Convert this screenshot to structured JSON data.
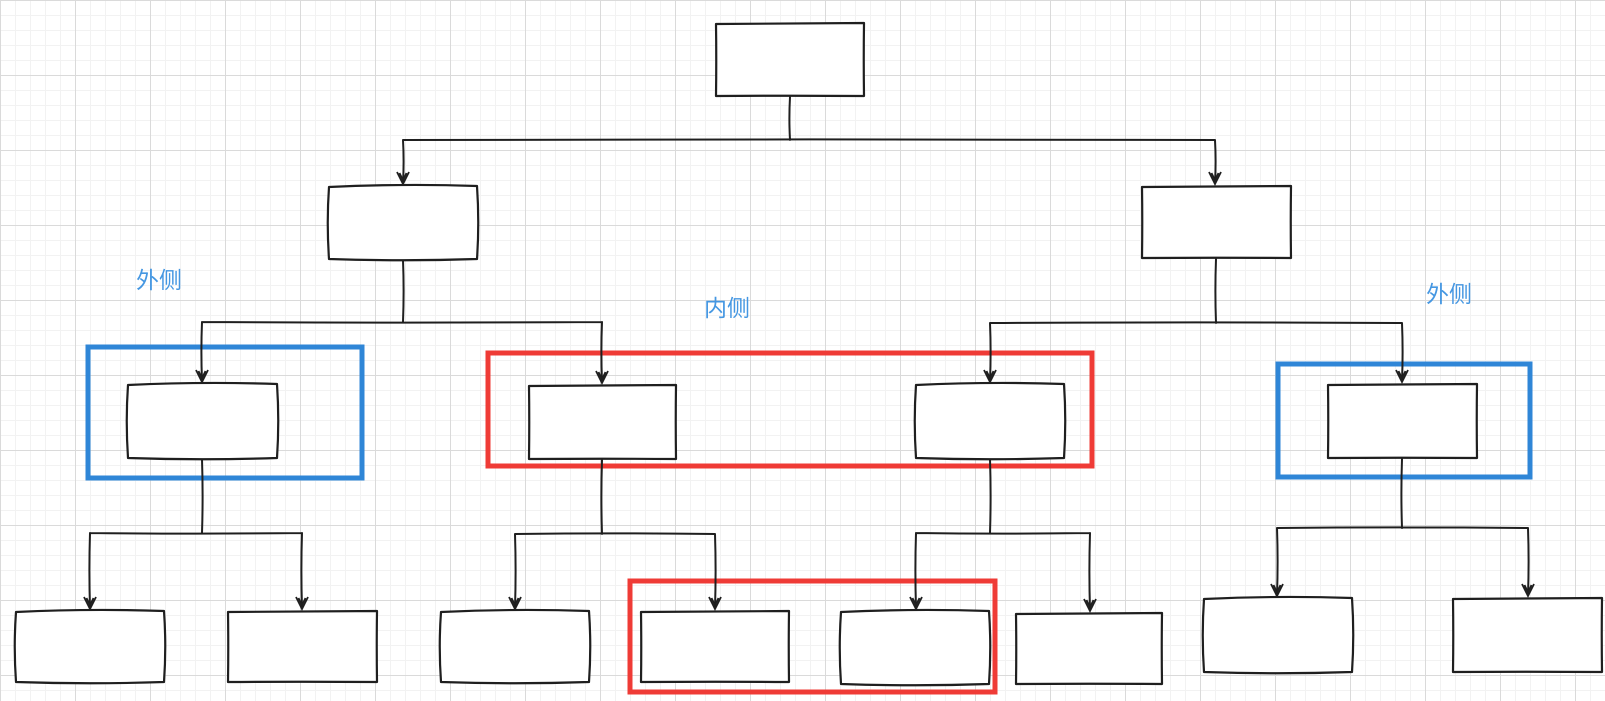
{
  "canvas": {
    "width": 1605,
    "height": 701,
    "background_color": "#ffffff",
    "grid": {
      "minor_color": "#f2f2f2",
      "major_color": "#dadada",
      "minor_step": 15,
      "major_step": 75
    }
  },
  "palette": {
    "node_stroke": "#1f1f1f",
    "node_fill": "#ffffff",
    "edge_color": "#1f1f1f",
    "blue": "#2f86d7",
    "red": "#ef3b36",
    "label_blue": "#4597e2"
  },
  "labels": [
    {
      "id": "label-outer-left",
      "text": "外侧",
      "x": 136,
      "y": 288,
      "color": "label_blue"
    },
    {
      "id": "label-inner",
      "text": "内侧",
      "x": 704,
      "y": 316,
      "color": "label_blue"
    },
    {
      "id": "label-outer-right",
      "text": "外侧",
      "x": 1426,
      "y": 302,
      "color": "label_blue"
    }
  ],
  "nodes": [
    {
      "id": "root",
      "x": 715,
      "y": 22,
      "w": 150,
      "h": 75
    },
    {
      "id": "branch-left",
      "x": 328,
      "y": 185,
      "w": 150,
      "h": 75
    },
    {
      "id": "branch-right",
      "x": 1141,
      "y": 185,
      "w": 151,
      "h": 74
    },
    {
      "id": "outer-left",
      "x": 127,
      "y": 383,
      "w": 151,
      "h": 76
    },
    {
      "id": "inner-left",
      "x": 528,
      "y": 384,
      "w": 149,
      "h": 76
    },
    {
      "id": "inner-right",
      "x": 915,
      "y": 383,
      "w": 150,
      "h": 76
    },
    {
      "id": "outer-right",
      "x": 1327,
      "y": 383,
      "w": 151,
      "h": 76
    },
    {
      "id": "leaf-1",
      "x": 15,
      "y": 610,
      "w": 150,
      "h": 73
    },
    {
      "id": "leaf-2",
      "x": 227,
      "y": 610,
      "w": 151,
      "h": 73
    },
    {
      "id": "leaf-3",
      "x": 440,
      "y": 610,
      "w": 150,
      "h": 73
    },
    {
      "id": "leaf-4",
      "x": 640,
      "y": 610,
      "w": 150,
      "h": 73
    },
    {
      "id": "leaf-5",
      "x": 840,
      "y": 610,
      "w": 150,
      "h": 75
    },
    {
      "id": "leaf-6",
      "x": 1015,
      "y": 612,
      "w": 148,
      "h": 73
    },
    {
      "id": "leaf-7",
      "x": 1203,
      "y": 597,
      "w": 150,
      "h": 76
    },
    {
      "id": "leaf-8",
      "x": 1452,
      "y": 597,
      "w": 151,
      "h": 76
    }
  ],
  "edges": [
    {
      "id": "root-to-branches",
      "from_x": 790,
      "from_y": 97,
      "split_y": 140,
      "targets": [
        {
          "x": 403,
          "y": 185
        },
        {
          "x": 1215,
          "y": 185
        }
      ]
    },
    {
      "id": "branch-left-children",
      "from_x": 403,
      "from_y": 260,
      "split_y": 322,
      "targets": [
        {
          "x": 202,
          "y": 383
        },
        {
          "x": 602,
          "y": 384
        }
      ]
    },
    {
      "id": "branch-right-children",
      "from_x": 1216,
      "from_y": 259,
      "split_y": 323,
      "targets": [
        {
          "x": 990,
          "y": 383
        },
        {
          "x": 1402,
          "y": 383
        }
      ]
    },
    {
      "id": "outer-left-children",
      "from_x": 202,
      "from_y": 459,
      "split_y": 533,
      "targets": [
        {
          "x": 90,
          "y": 610
        },
        {
          "x": 302,
          "y": 610
        }
      ]
    },
    {
      "id": "inner-left-children",
      "from_x": 602,
      "from_y": 460,
      "split_y": 534,
      "targets": [
        {
          "x": 515,
          "y": 610
        },
        {
          "x": 715,
          "y": 610
        }
      ]
    },
    {
      "id": "inner-right-children",
      "from_x": 990,
      "from_y": 459,
      "split_y": 533,
      "targets": [
        {
          "x": 916,
          "y": 610
        },
        {
          "x": 1090,
          "y": 612
        }
      ]
    },
    {
      "id": "outer-right-children",
      "from_x": 1402,
      "from_y": 459,
      "split_y": 528,
      "targets": [
        {
          "x": 1277,
          "y": 597
        },
        {
          "x": 1528,
          "y": 597
        }
      ]
    }
  ],
  "highlights": [
    {
      "id": "outer-left",
      "color": "blue",
      "x": 88,
      "y": 347,
      "w": 274,
      "h": 131
    },
    {
      "id": "inner-pair",
      "color": "red",
      "x": 488,
      "y": 353,
      "w": 604,
      "h": 113
    },
    {
      "id": "outer-right",
      "color": "blue",
      "x": 1278,
      "y": 364,
      "w": 252,
      "h": 113
    },
    {
      "id": "bottom-pair",
      "color": "red",
      "x": 630,
      "y": 581,
      "w": 365,
      "h": 111
    }
  ]
}
